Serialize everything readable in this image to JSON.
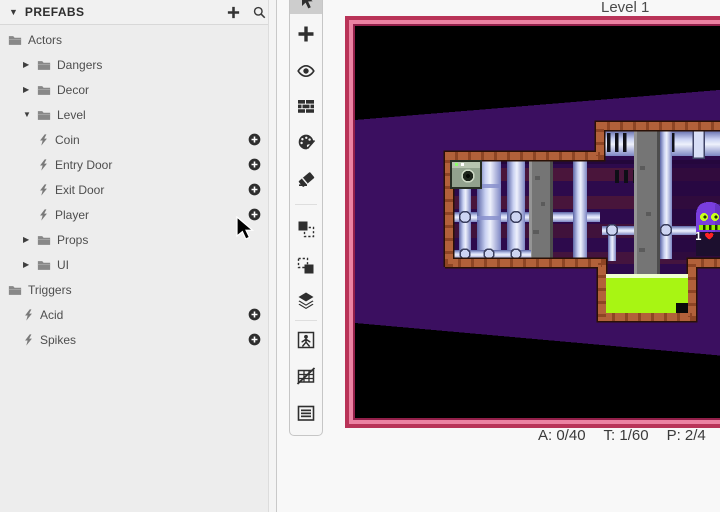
{
  "sidebar": {
    "header": {
      "title": "PREFABS"
    },
    "tree": [
      {
        "label": "Actors",
        "type": "folder",
        "depth": 0,
        "expanded": true
      },
      {
        "label": "Dangers",
        "type": "folder",
        "depth": 1,
        "expanded": false
      },
      {
        "label": "Decor",
        "type": "folder",
        "depth": 1,
        "expanded": false
      },
      {
        "label": "Level",
        "type": "folder",
        "depth": 1,
        "expanded": true
      },
      {
        "label": "Coin",
        "type": "prefab",
        "depth": 2,
        "addable": true
      },
      {
        "label": "Entry Door",
        "type": "prefab",
        "depth": 2,
        "addable": true
      },
      {
        "label": "Exit Door",
        "type": "prefab",
        "depth": 2,
        "addable": true
      },
      {
        "label": "Player",
        "type": "prefab",
        "depth": 2,
        "addable": true
      },
      {
        "label": "Props",
        "type": "folder",
        "depth": 1,
        "expanded": false
      },
      {
        "label": "UI",
        "type": "folder",
        "depth": 1,
        "expanded": false
      },
      {
        "label": "Triggers",
        "type": "folder",
        "depth": 0,
        "expanded": true
      },
      {
        "label": "Acid",
        "type": "prefab",
        "depth": 1,
        "addable": true
      },
      {
        "label": "Spikes",
        "type": "prefab",
        "depth": 1,
        "addable": true
      }
    ]
  },
  "toolbar": {
    "tools": [
      {
        "name": "select",
        "icon": "cursor-icon",
        "selected": true
      },
      {
        "name": "add-actor",
        "icon": "plus-icon",
        "selected": false
      },
      {
        "name": "visibility",
        "icon": "eye-icon",
        "selected": false
      },
      {
        "name": "tile-brush",
        "icon": "bricks-icon",
        "selected": false
      },
      {
        "name": "paint",
        "icon": "palette-icon",
        "selected": false
      },
      {
        "name": "eraser",
        "icon": "eraser-icon",
        "selected": false
      },
      {
        "name": "bring-to-front",
        "icon": "copy-front-icon",
        "selected": false
      },
      {
        "name": "send-to-back",
        "icon": "copy-back-icon",
        "selected": false
      },
      {
        "name": "layers",
        "icon": "layers-icon",
        "selected": false
      },
      {
        "name": "actor-frame",
        "icon": "person-box-icon",
        "selected": false
      },
      {
        "name": "toggle-grid",
        "icon": "grid-off-icon",
        "selected": false
      },
      {
        "name": "properties",
        "icon": "list-icon",
        "selected": false
      }
    ]
  },
  "viewport": {
    "title": "Level 1",
    "stats": [
      {
        "id": "actors",
        "text": "A: 0/40"
      },
      {
        "id": "tiles",
        "text": "T: 1/60"
      },
      {
        "id": "prefabs",
        "text": "P: 2/4"
      }
    ],
    "hud": {
      "lives": "1"
    }
  },
  "colors": {
    "frame_border": "#b93358",
    "frame_border_light": "#ec82a2",
    "scene_purple": "#3b0f60",
    "room_copper": "#b2613a",
    "acid_green": "#a8f513",
    "player_purple": "#7a3ede"
  }
}
